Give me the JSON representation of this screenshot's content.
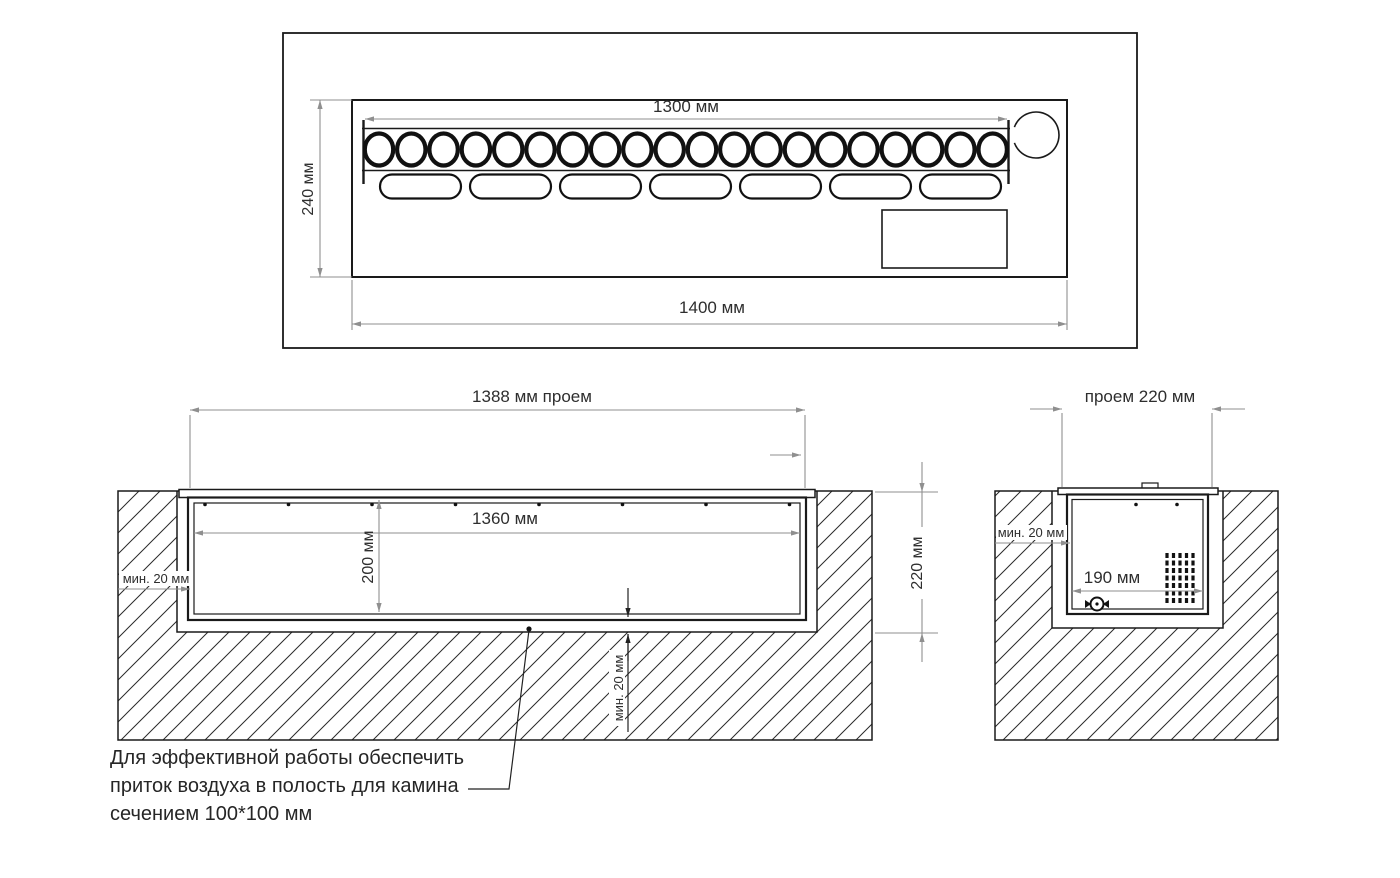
{
  "drawing": {
    "top_view": {
      "dim_burner_row": "1300 мм",
      "dim_depth": "240 мм",
      "dim_total_width": "1400 мм",
      "burner_hole_count": 20,
      "slot_count": 7
    },
    "front_section": {
      "dim_opening": "1388 мм проем",
      "dim_insert_inner_width": "1360 мм",
      "dim_insert_depth": "200 мм",
      "dim_recess_depth": "220 мм",
      "dim_side_gap": "мин. 20 мм",
      "dim_bottom_gap": "мин. 20 мм"
    },
    "side_section": {
      "dim_opening": "проем 220 мм",
      "dim_side_gap": "мин. 20 мм",
      "dim_inner_width": "190 мм"
    },
    "note": {
      "line1": "Для эффективной работы обеспечить",
      "line2": "приток воздуха в полость для камина",
      "line3": "сечением 100*100 мм"
    }
  }
}
